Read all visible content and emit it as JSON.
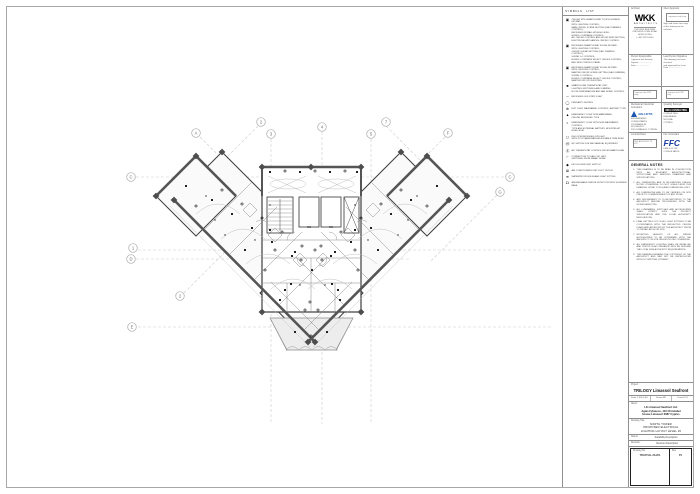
{
  "legend": {
    "header_left": "SYMBOLS",
    "header_right": "LIST",
    "items": [
      {
        "icon": "▣",
        "lines": [
          "CEILING MTD SMART HOME 'TOUCH SCREEN' KEYPAD,",
          "WITH LIGHTING CONTROL,",
          "MAIN ON/OFF, SCENE SETTING (DALI DIMMING CONTROL),",
          "RECESSED IN WALL AT HIGH LEVEL,",
          "BLINDS / CURTAINS CONTROL,",
          "A/C ON/OFF CONTROL AND ROOM TEMP SETTING,",
          "ELECTRICAL APPLIANCES ON/OFF CONTROL"
        ]
      },
      {
        "icon": "▣",
        "lines": [
          "RECESSED SMART HOME 'FLUSH KEYPAD',",
          "WITH LIGHTING CONTROL,",
          "ON/OFF SCENE SETTING (DALI DIMMING CONTROL),",
          "SCENE 1+2 CONTROL,",
          "BLINDS / CURTAINS SELECT ON/OFF CONTROL,",
          "BED SIDE CONTROL PANEL"
        ]
      },
      {
        "icon": "▣",
        "lines": [
          "RECESSED SMART HOME 'FLUSH KEYPAD',",
          "WITH LIGHTING CONTROL,",
          "MASTER ON/OFF SCENE SETTING (DALI DIMMING),",
          "SCENE 1 CONTROL,",
          "BLINDS / CURTAINS SELECT ON/OFF CONTROL,",
          "MASTER OFF UPON EXITING"
        ]
      },
      {
        "icon": "■",
        "lines": [
          "SMART HOME THERMOSTAT UNIT,",
          "LIGHTING SWITCHING AND DIMMING,",
          "ROOM TEMPERATURE AND FAN SPEED CONTROL"
        ]
      },
      {
        "icon": "─",
        "lines": [
          "RECESSED LED STRIP LIGHT"
        ]
      },
      {
        "icon": "◯",
        "lines": [
          "PENDANT LIGHTING"
        ]
      },
      {
        "icon": "⊕",
        "lines": [
          "EXIT LIGHT MAINTAINED CONTROL, BATTERY TYPE"
        ]
      },
      {
        "icon": "▲",
        "lines": [
          "EMERGENCY LIGHT NON-MAINTAINED,",
          "CEILING RECESSED TYPE"
        ]
      },
      {
        "icon": "◐",
        "lines": [
          "EMERGENCY LIGHT WITH NON-MAINTAINED CONTROL,",
          "TYPE AND EXTERNAL BATTERY, MOUNTED AT",
          "HIGH LEVEL"
        ]
      },
      {
        "icon": "◻",
        "lines": [
          "IN-FLOOR RECESSED UPLIGHT,",
          "WITH POLYCARBONATE ADJUSTABLE TRIM INLAY"
        ]
      },
      {
        "icon": "Ⓜ",
        "lines": [
          "MC SWITCH FOR MECHANICAL EQUIPMENT"
        ]
      },
      {
        "icon": "Ⓢ",
        "lines": [
          "A/C THERMOSTAT CONTROL FROM SMART HOME"
        ]
      },
      {
        "icon": "⌐",
        "lines": [
          "CONNECTION TO FAN COIL UNIT,",
          "SWITCHED FROM SMART HOME"
        ]
      },
      {
        "icon": "◆",
        "lines": [
          "KEY HOLDER UNIT SWITCH"
        ]
      },
      {
        "icon": "⊠",
        "lines": [
          "AIR CONDITIONING UNIT DUCT OUTLET"
        ]
      },
      {
        "icon": "≋",
        "lines": [
          "WATERPROOF BULKHEAD LIGHT FITTING"
        ]
      },
      {
        "icon": "☊",
        "lines": [
          "ADDRESSABLE SMOKE DETECTOR WITH SOUNDER BASE"
        ]
      }
    ]
  },
  "titleblock": {
    "architect_label": "Architect",
    "wkk_logo": "WKK",
    "wkk_sub": "ARCHITECTS",
    "wkk_lines": [
      "15/F WKK BUILDING",
      "418 KWUN TONG ROAD",
      "HONG KONG",
      "t +852 2357 0000"
    ],
    "client_box_label": "Client Approval",
    "client_box_note": "signature and chop",
    "client_box_lines": [
      "Sign and return one copy",
      "of this drawing to the architect"
    ],
    "person_label": "Person Responsible",
    "person_lines": [
      "I approve this drawing",
      "Signed .....................",
      "Date ....................."
    ],
    "lead_label": "Lead Person Signature",
    "lead_lines": [
      "This drawing has been checked",
      "and approved for issue",
      "Date ....................."
    ],
    "sign_left": "I approve this PDF copy",
    "sign_right": "I approve this PDF copy",
    "mep_label": "Mechanical / Electrical Consultant",
    "mep_name": "MALLIOTIS",
    "mep_lines": [
      "ENGINEERING CONSULTANTS",
      "123 FRANKLIN ROOSEVELT",
      "3011 LIMASSOL CYPRUS"
    ],
    "qs_label": "Quantity Surveyor",
    "qs_name": "MDA CONSULTING",
    "qs_lines": [
      "CONSULTING ENGINEERS",
      "NICOSIA",
      "CYPRUS"
    ],
    "local_label": "Local Architect",
    "local_box": "UDS ARCHITECTS LTD",
    "fire_label": "Fire Consultant",
    "ffc_logo": "FFC",
    "ffc_lines": [
      "FIRE & FLOW",
      "CONSULTANTS"
    ]
  },
  "general_notes": {
    "title": "GENERAL NOTES",
    "notes": [
      "THIS DRAWING IS TO BE READ IN CONJUNCTION WITH ALL RELEVANT ARCHITECTURAL, STRUCTURAL AND SERVICES DRAWINGS AND SPECIFICATIONS.",
      "ALL DIMENSIONS ARE IN MILLIMETRES UNLESS NOTED OTHERWISE. DO NOT SCALE FROM THIS DRAWING; WORK TO FIGURED DIMENSIONS ONLY.",
      "ALL DIMENSIONS ARE TO BE VERIFIED ON SITE PRIOR TO COMMENCEMENT OF ANY WORK.",
      "ANY DISCREPANCY IS TO BE REPORTED TO THE ARCHITECT BEFORE PROCEEDING WITH THE WORKS AFFECTED.",
      "ALL LUMINAIRES, SWITCHES AND ACCESSORIES SHALL COMPLY WITH THE PROJECT SPECIFICATION AND THE LOCAL AUTHORITY REGULATIONS.",
      "FINAL SETTING OUT OF ALL LIGHT FITTINGS TO BE COORDINATED WITH THE REFLECTED CEILING PLANS AND APPROVED BY THE ARCHITECT PRIOR TO INSTALLATION ON SITE.",
      "MOUNTING HEIGHTS OF ALL WIRING ACCESSORIES TO BE CONFIRMED WITH THE ARCHITECT ON SITE UNLESS NOTED OTHERWISE.",
      "ALL EMERGENCY LIGHTING SHALL BE INSTALLED AND TESTED IN ACCORDANCE WITH EN 1838 AND THE LOCAL FIRE AUTHORITY REQUIREMENTS.",
      "THIS DRAWING REMAINS THE COPYRIGHT OF THE ARCHITECT AND MAY NOT BE REPRODUCED WITHOUT WRITTEN CONSENT."
    ]
  },
  "project_block": {
    "project_label": "Project:",
    "project_name": "TRILOGY Limassol Seafront",
    "meta": [
      "Scale  1:100 @ A1",
      "Drawn  MK",
      "Date  05.21"
    ],
    "client_label": "Client:",
    "client_lines": [
      "LK Limassol Seafront Ltd.",
      "Agias Fylaxeos, 110 Christabel",
      "House Limassol 3087 Cyprus"
    ],
    "title_label": "Drawing Title:",
    "title_lines": [
      "NORTH TOWER",
      "PROPOSED ELECTRICAL",
      "LIGHTING LAYOUT LEVEL 26"
    ],
    "status_label": "Status:",
    "status_value": "Suitability Description",
    "revision_label": "Revision:",
    "revision_value": "Revision Description",
    "drawing_no_label": "Drawing No.",
    "drawing_no_value": "TRI-NT-EL-26-201",
    "rev_label": "Rev",
    "rev_value": "P1"
  },
  "plan": {
    "bubbles": [
      {
        "label": "A",
        "x": 196,
        "y": 133
      },
      {
        "label": "2",
        "x": 261,
        "y": 122
      },
      {
        "label": "3",
        "x": 271,
        "y": 134
      },
      {
        "label": "4",
        "x": 322,
        "y": 127
      },
      {
        "label": "5",
        "x": 371,
        "y": 134
      },
      {
        "label": "7",
        "x": 386,
        "y": 122
      },
      {
        "label": "F",
        "x": 448,
        "y": 133
      },
      {
        "label": "C",
        "x": 131,
        "y": 177
      },
      {
        "label": "1",
        "x": 133,
        "y": 248
      },
      {
        "label": "D",
        "x": 131,
        "y": 259
      },
      {
        "label": "2",
        "x": 180,
        "y": 296
      },
      {
        "label": "E",
        "x": 132,
        "y": 327
      },
      {
        "label": "C",
        "x": 510,
        "y": 177
      },
      {
        "label": "G",
        "x": 500,
        "y": 192
      }
    ],
    "columns": [
      [
        222,
        152
      ],
      [
        401,
        152
      ],
      [
        196,
        156
      ],
      [
        427,
        156
      ],
      [
        156,
        196
      ],
      [
        467,
        196
      ],
      [
        174,
        200
      ],
      [
        449,
        200
      ],
      [
        262,
        167
      ],
      [
        311,
        167
      ],
      [
        361,
        167
      ],
      [
        262,
        312
      ],
      [
        361,
        312
      ],
      [
        315,
        342
      ],
      [
        308,
        342
      ]
    ],
    "symbols": [
      [
        212,
        200,
        0
      ],
      [
        222,
        190,
        1
      ],
      [
        232,
        214,
        0
      ],
      [
        242,
        204,
        1
      ],
      [
        252,
        228,
        0
      ],
      [
        262,
        218,
        1
      ],
      [
        272,
        242,
        0
      ],
      [
        282,
        232,
        1
      ],
      [
        292,
        256,
        0
      ],
      [
        302,
        246,
        1
      ],
      [
        312,
        270,
        0
      ],
      [
        322,
        260,
        1
      ],
      [
        332,
        284,
        0
      ],
      [
        225,
        235,
        2
      ],
      [
        245,
        250,
        0
      ],
      [
        265,
        270,
        1
      ],
      [
        285,
        290,
        0
      ],
      [
        305,
        310,
        1
      ],
      [
        215,
        220,
        2
      ],
      [
        255,
        240,
        2
      ],
      [
        411,
        200,
        0
      ],
      [
        401,
        190,
        1
      ],
      [
        391,
        214,
        0
      ],
      [
        381,
        204,
        1
      ],
      [
        371,
        228,
        0
      ],
      [
        361,
        218,
        1
      ],
      [
        351,
        242,
        0
      ],
      [
        341,
        232,
        1
      ],
      [
        331,
        256,
        0
      ],
      [
        321,
        246,
        1
      ],
      [
        301,
        260,
        1
      ],
      [
        291,
        284,
        0
      ],
      [
        398,
        235,
        2
      ],
      [
        378,
        250,
        0
      ],
      [
        358,
        270,
        1
      ],
      [
        338,
        290,
        0
      ],
      [
        318,
        310,
        1
      ],
      [
        408,
        220,
        2
      ],
      [
        368,
        240,
        2
      ],
      [
        270,
        172,
        0
      ],
      [
        285,
        171,
        1
      ],
      [
        300,
        172,
        0
      ],
      [
        315,
        171,
        1
      ],
      [
        330,
        172,
        0
      ],
      [
        345,
        171,
        1
      ],
      [
        357,
        172,
        0
      ],
      [
        270,
        205,
        2
      ],
      [
        355,
        205,
        2
      ],
      [
        270,
        230,
        0
      ],
      [
        355,
        230,
        0
      ],
      [
        275,
        250,
        1
      ],
      [
        295,
        252,
        0
      ],
      [
        315,
        250,
        1
      ],
      [
        335,
        252,
        0
      ],
      [
        355,
        250,
        1
      ],
      [
        280,
        300,
        0
      ],
      [
        310,
        302,
        1
      ],
      [
        340,
        300,
        0
      ],
      [
        300,
        285,
        2
      ],
      [
        325,
        285,
        2
      ],
      [
        186,
        186,
        0
      ],
      [
        196,
        206,
        1
      ],
      [
        206,
        196,
        2
      ],
      [
        437,
        186,
        0
      ],
      [
        427,
        206,
        1
      ],
      [
        417,
        196,
        2
      ],
      [
        295,
        332,
        0
      ],
      [
        311,
        336,
        1
      ],
      [
        327,
        332,
        0
      ]
    ]
  }
}
